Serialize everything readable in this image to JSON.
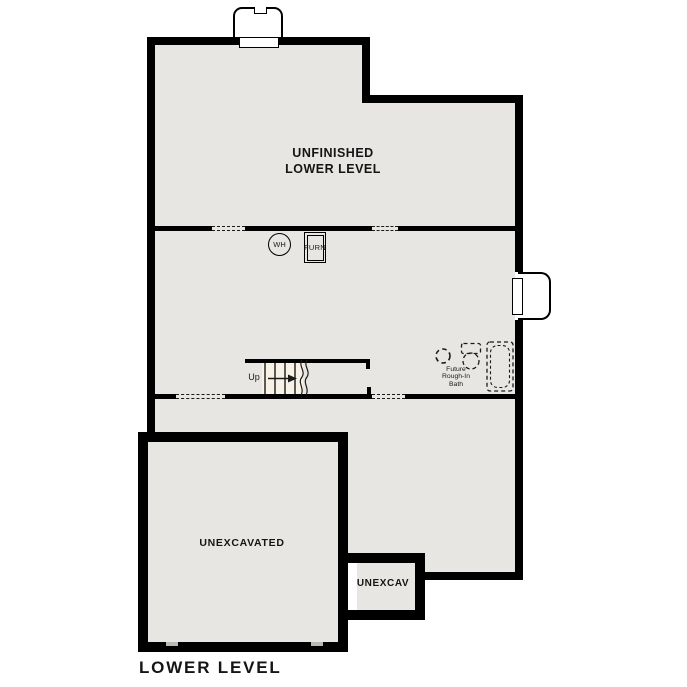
{
  "plan": {
    "title": "LOWER LEVEL",
    "colors": {
      "wall": "#000000",
      "floor": "#e8e6e3",
      "stair_fill": "#f8f2e6",
      "paper": "#ffffff",
      "line": "#1a1a1a"
    },
    "rooms": {
      "unfinished": {
        "line1": "UNFINISHED",
        "line2": "LOWER LEVEL"
      },
      "unexcavated": {
        "name": "UNEXCAVATED"
      },
      "unexcav_small": {
        "name": "UNEXCAV"
      }
    },
    "annotations": {
      "water_heater": "WH",
      "furnace": "FURN",
      "stairs_up": "Up",
      "bath": {
        "line1": "Future",
        "line2": "Rough-In",
        "line3": "Bath"
      }
    }
  }
}
